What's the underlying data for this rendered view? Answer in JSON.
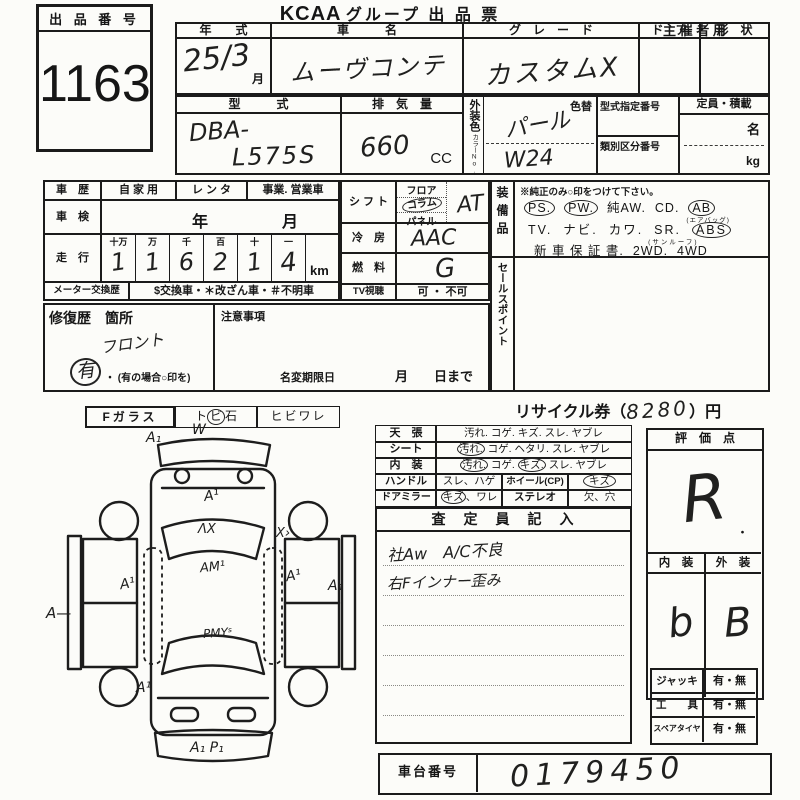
{
  "page": {
    "brand": "KCAA",
    "title": "グループ 出 品 票",
    "organizer": "主 催 者 用"
  },
  "auction_no": {
    "label": "出 品 番 号",
    "value": "1163"
  },
  "top_table": {
    "year": {
      "header": "年　　式",
      "value": "25/3",
      "unit": "月"
    },
    "name": {
      "header": "車　　　名",
      "value": "ムーヴコンテ"
    },
    "grade": {
      "header": "グ　レ　ー　ド",
      "value": "カスタムX"
    },
    "door": {
      "header": "ド　ア"
    },
    "shape": {
      "header": "形　状"
    },
    "model": {
      "header": "型　　　式",
      "line1": "DBA-",
      "line2": "L575S"
    },
    "disp": {
      "header": "排　気　量",
      "value": "660",
      "unit": "CC"
    },
    "color": {
      "side_label": "外装色",
      "color_no_label": "カラーNo.",
      "change_label": "色替",
      "value": "パール",
      "color_no": "W24"
    },
    "type_no": {
      "header": "型式指定番号"
    },
    "class_no": {
      "header": "類別区分番号"
    },
    "capacity": {
      "header": "定員・積載",
      "persons": "名",
      "weight": "kg"
    }
  },
  "history_table": {
    "car_history": {
      "label": "車　歴",
      "opt1": "自 家 用",
      "opt2": "レ ン タ",
      "opt3": "事業. 営業車"
    },
    "inspection": {
      "label": "車　検",
      "year_label": "年",
      "month_label": "月"
    },
    "mileage": {
      "label": "走　行",
      "cols": [
        "十万",
        "万",
        "千",
        "百",
        "十",
        "一"
      ],
      "digits": [
        "1",
        "1",
        "6",
        "2",
        "1",
        "4"
      ],
      "unit": "km"
    },
    "meter": {
      "label": "メーター交換歴",
      "text": "$交換車・＊改ざん車・＃不明車"
    }
  },
  "shift_block": {
    "shift": {
      "label": "シ フ ト",
      "opt1": "フロア",
      "opt2": "コラム",
      "opt3": "パネル",
      "value": "AT"
    },
    "cooling": {
      "label": "冷　房",
      "value": "AAC"
    },
    "fuel": {
      "label": "燃　料",
      "value": "G"
    },
    "tv": {
      "label": "TV視聴",
      "text": "可 ・ 不可"
    }
  },
  "equipment": {
    "side_label": "装備品",
    "note": "※純正のみ○印をつけて下さい。",
    "r1": [
      "PS.",
      "PW.",
      "純AW.",
      "CD.",
      "AB"
    ],
    "r1_sub": "(エアバッグ)",
    "r2": [
      "TV.",
      "ナビ.",
      "カワ.",
      "SR.",
      "ABS"
    ],
    "r2_sub": "(サンルーフ)",
    "r3": [
      "新 車 保 証 書.",
      "2WD.",
      "4WD"
    ]
  },
  "sales_point": {
    "side_label": "セールスポイント"
  },
  "repair": {
    "label": "修復歴　箇所",
    "note": "フロント",
    "value": "有",
    "hint": "・ (有の場合○印を)"
  },
  "caution": {
    "label": "注意事項",
    "deadline_label": "名変期限日",
    "deadline_suffix": "月　　日まで"
  },
  "recycle": {
    "prefix": "リサイクル券（",
    "value": "8280",
    "suffix": "）円"
  },
  "f_glass": {
    "label": "Fガラス",
    "opt1_a": "ト",
    "opt1_b": "ビ",
    "opt1_c": "石",
    "opt2": "ヒビワレ"
  },
  "diagram": {
    "annotations": [
      "A₁",
      "W",
      "A¹",
      "ΛX",
      "X›",
      "AM¹",
      "A¹",
      "A¹",
      "A₁",
      "A—",
      "PMYˢ",
      "A¹",
      "A₁ P₁"
    ]
  },
  "condition": {
    "rows": [
      {
        "label": "天　張",
        "i0": "汚れ.",
        "i1": "コゲ.",
        "i2": "キズ.",
        "i3": "スレ.",
        "i4": "ヤブレ"
      },
      {
        "label": "シート",
        "i0": "汚れ.",
        "i1": "コゲ.",
        "i2": "ヘタリ.",
        "i3": "スレ.",
        "i4": "ヤブレ"
      },
      {
        "label": "内　装",
        "i0": "汚れ.",
        "i1": "コゲ.",
        "i2": "キズ.",
        "i3": "スレ.",
        "i4": "ヤブレ"
      }
    ],
    "handle_label": "ハンドル",
    "handle_value": "スレ、ハゲ",
    "wheel_label": "ホイール(CP)",
    "wheel_value": "キズ",
    "mirror_label": "ドアミラー",
    "mirror_v1": "キズ",
    "mirror_v2": "、ワレ",
    "stereo_label": "ステレオ",
    "stereo_value": "欠、穴"
  },
  "inspector": {
    "header": "査　定　員　記　入",
    "note1": "社Aw　A/C不良",
    "note2": "右Fインナー歪み"
  },
  "evaluation": {
    "header": "評　価　点",
    "score": "R",
    "score_dot": "・",
    "interior_label": "内　装",
    "exterior_label": "外　装",
    "interior": "b",
    "exterior": "B"
  },
  "accessories": {
    "rows": [
      {
        "label": "ジャッキ",
        "value": "有・無"
      },
      {
        "label": "工　　具",
        "value": "有・無"
      },
      {
        "label": "スペアタイヤ",
        "value": "有・無"
      }
    ]
  },
  "chassis": {
    "label": "車台番号",
    "value": "0179450"
  }
}
